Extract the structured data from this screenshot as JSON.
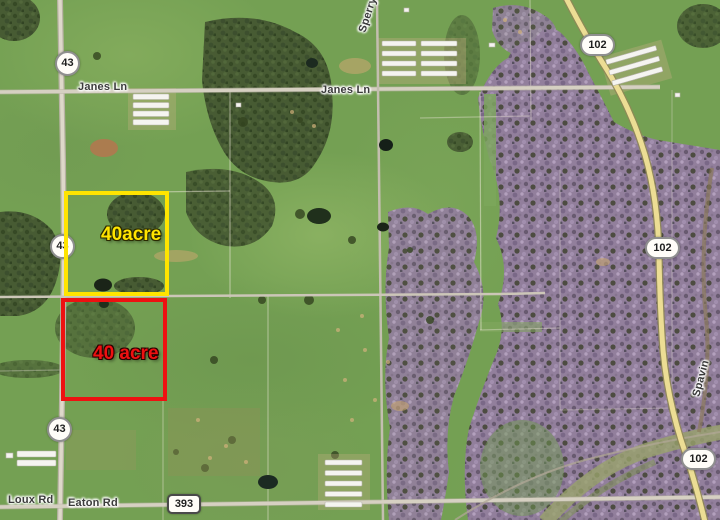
{
  "map": {
    "road_labels": {
      "janes_ln_west": "Janes Ln",
      "janes_ln_east": "Janes Ln",
      "sperry_rd": "Sperry",
      "loux_rd": "Loux Rd",
      "eaton_rd": "Eaton Rd",
      "spavinaw": "Spavin"
    },
    "route_shields": {
      "hwy43_top": "43",
      "hwy43_mid": "43",
      "hwy43_bottom": "43",
      "hwy102_top": "102",
      "hwy102_mid": "102",
      "hwy102_bottom": "102",
      "road_393": "393"
    },
    "parcels": {
      "yellow": {
        "label": "40acre",
        "outline_color": "#ffe400"
      },
      "red": {
        "label": "40 acre",
        "outline_color": "#ee1111"
      }
    }
  }
}
